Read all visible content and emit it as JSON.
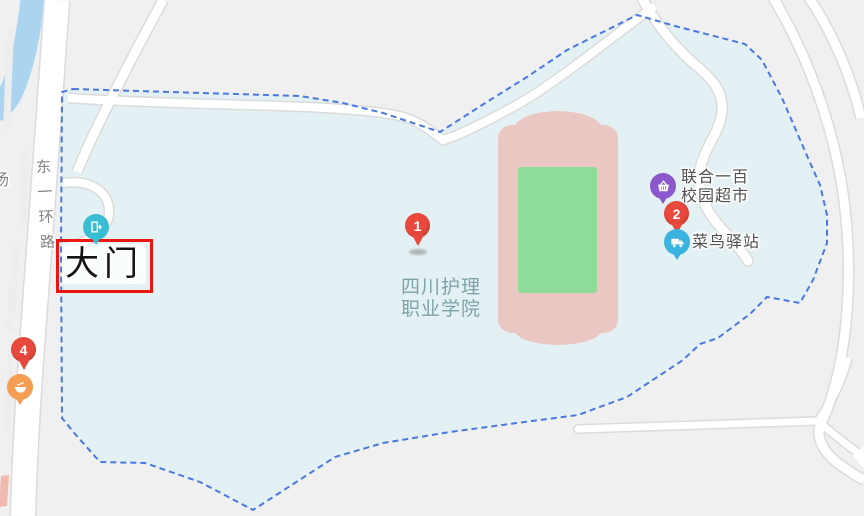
{
  "map": {
    "region": {
      "name": "四川护理职业学院",
      "label_line1": "四川护理",
      "label_line2": "职业学院"
    },
    "annotation": {
      "label": "大门"
    },
    "road_label": {
      "text": "东一环路",
      "chars": [
        "东",
        "一",
        "环",
        "路"
      ]
    },
    "edge_label": "汤",
    "pois": [
      {
        "name": "联合一百校园超市",
        "line1": "联合一百",
        "line2": "校园超市",
        "icon": "supermarket-basket-icon",
        "color": "#8a57cc"
      },
      {
        "name": "菜鸟驿站",
        "line1": "菜鸟驿站",
        "icon": "parcel-station-icon",
        "color": "#3ab4de"
      },
      {
        "name": "大门",
        "icon": "gate-icon",
        "color": "#38bdd2"
      },
      {
        "name": "",
        "icon": "restaurant-icon",
        "color": "#f59d52"
      }
    ],
    "markers": [
      {
        "number": "1"
      },
      {
        "number": "2"
      },
      {
        "number": "4"
      }
    ]
  },
  "colors": {
    "bg-outer": "#f0f0f1",
    "campus": "#e4f1f4",
    "boundary": "#4a78e0",
    "road-fill": "#ffffff",
    "road-casing": "#dbdbdb",
    "river": "#abd4f1",
    "stadium-pink": "#ebc7c3",
    "field-green": "#8fdc98",
    "balloon-red": "#e8493c",
    "box-red": "#e9170e",
    "gate-teal": "#38bdd2",
    "supermarket-purple": "#8a57cc",
    "cainiao-blue": "#3ab4de",
    "food-orange": "#f59d52",
    "poi-label": "#4f4f4f",
    "school-label": "#7ca3a8",
    "road-label": "#828282"
  }
}
